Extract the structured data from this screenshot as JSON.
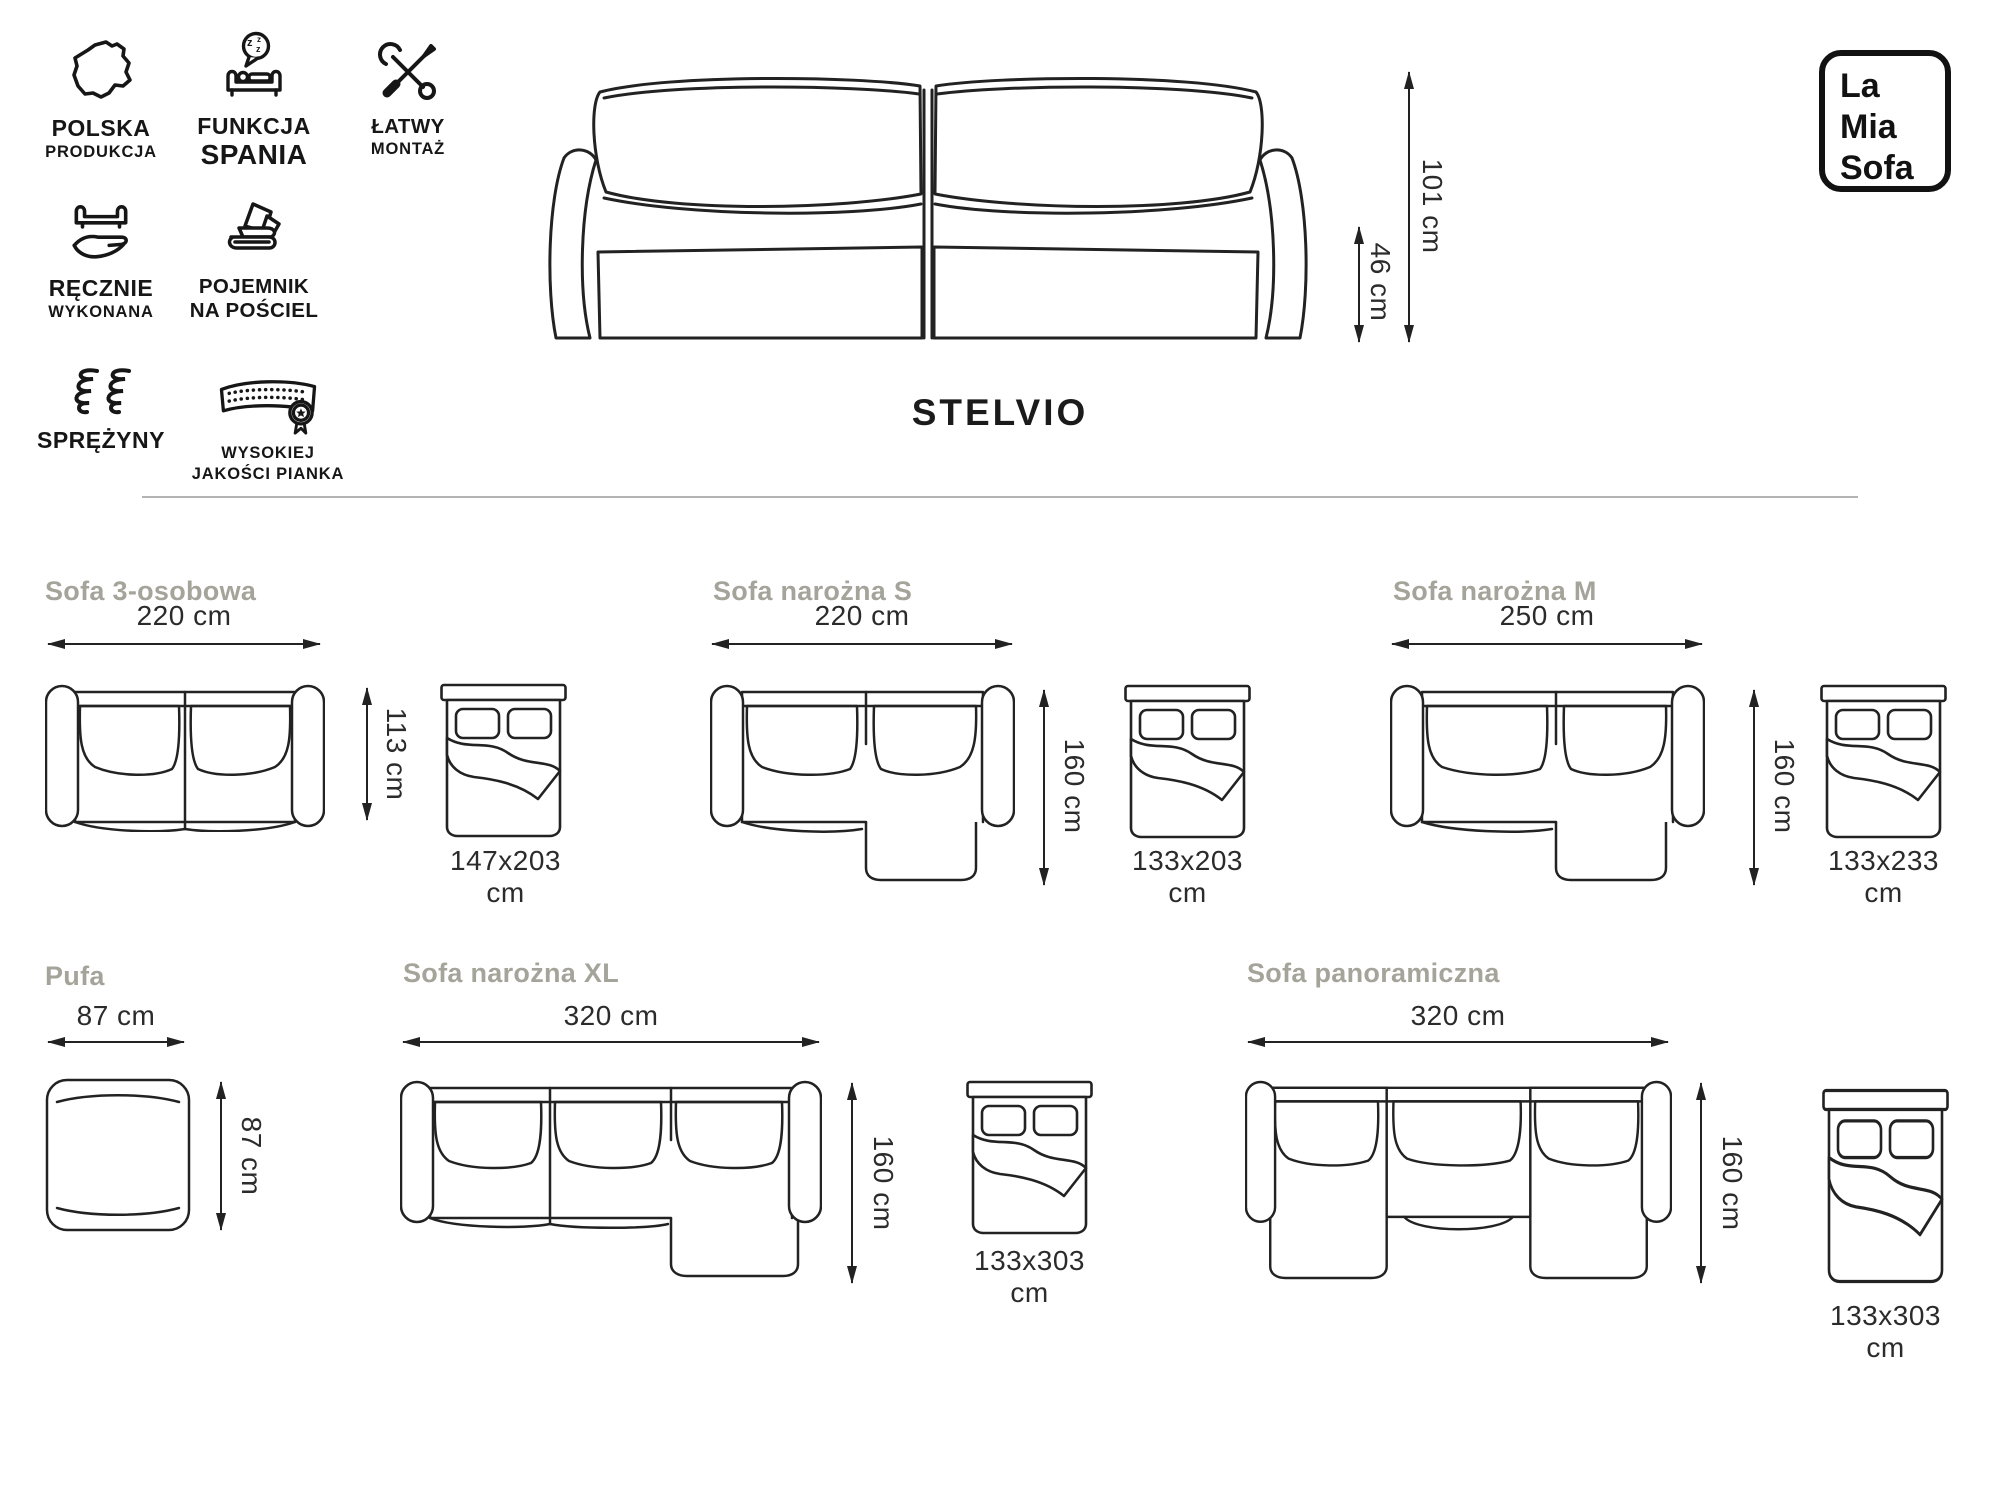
{
  "brand": {
    "line1": "La",
    "line2": "Mia",
    "line3": "Sofa"
  },
  "header": {
    "product_title": "STELVIO"
  },
  "hero_dimensions": {
    "total_height": "101 cm",
    "seat_height": "46 cm"
  },
  "features": [
    {
      "icon": "poland-map-icon",
      "line1": "POLSKA",
      "line2": "PRODUKCJA"
    },
    {
      "icon": "sleep-function-icon",
      "line1": "FUNKCJA",
      "line2": "SPANIA"
    },
    {
      "icon": "tools-icon",
      "line1": "ŁATWY",
      "line2": "MONTAŻ"
    },
    {
      "icon": "handmade-icon",
      "line1": "RĘCZNIE",
      "line2": "WYKONANA"
    },
    {
      "icon": "bedding-container-icon",
      "line1": "POJEMNIK",
      "line2": "NA POŚCIEL"
    },
    {
      "icon": "springs-icon",
      "line1": "SPRĘŻYNY",
      "line2": ""
    },
    {
      "icon": "foam-quality-icon",
      "line1": "WYSOKIEJ",
      "line2": "JAKOŚCI PIANKA"
    }
  ],
  "variants": [
    {
      "name": "Sofa 3-osobowa",
      "width": "220 cm",
      "depth": "113 cm",
      "bed": "147x203 cm"
    },
    {
      "name": "Sofa narożna S",
      "width": "220 cm",
      "depth": "160 cm",
      "bed": "133x203 cm"
    },
    {
      "name": "Sofa narożna M",
      "width": "250 cm",
      "depth": "160 cm",
      "bed": "133x233 cm"
    },
    {
      "name": "Pufa",
      "width": "87 cm",
      "depth": "87 cm"
    },
    {
      "name": "Sofa narożna XL",
      "width": "320 cm",
      "depth": "160 cm",
      "bed": "133x303 cm"
    },
    {
      "name": "Sofa panoramiczna",
      "width": "320 cm",
      "depth": "160 cm",
      "bed": "133x303 cm"
    }
  ],
  "colors": {
    "line": "#222222",
    "heading_gray": "#a5a49a",
    "divider": "#b3b3b3"
  }
}
